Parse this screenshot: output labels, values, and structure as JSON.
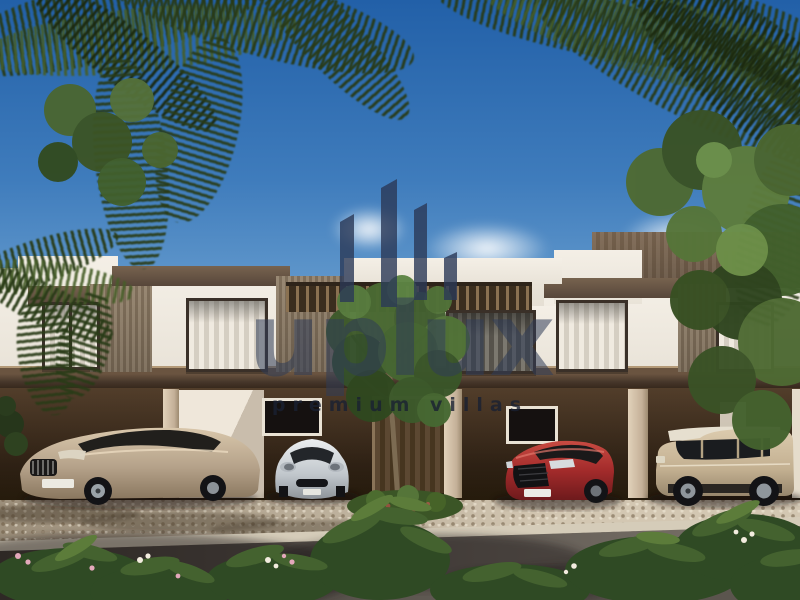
{
  "watermark": {
    "brand": "uplux",
    "tagline": "premium villas",
    "logo_icon": "skyline-bars-icon",
    "color": "#2f3c58"
  },
  "scene": {
    "type": "architectural-exterior-render",
    "title": "Modern two-storey townhouse row with carports",
    "time_of_day": "day",
    "sky": {
      "top_color": "#2260a8",
      "horizon_color": "#bdd6ea",
      "clouds": 3
    },
    "building": {
      "storeys": 2,
      "style": "contemporary flat-roof townhouses",
      "materials": [
        "white render",
        "timber slat panels",
        "dark bronze window frames"
      ],
      "features": [
        "rooftop parapets",
        "slatted pergola balcony",
        "shaded carports",
        "central entrance door",
        "curtained windows"
      ]
    },
    "vehicles": [
      {
        "name": "luxury sedan",
        "color_hex": "#b5a28a",
        "position": "left carport"
      },
      {
        "name": "sports car",
        "color_hex": "#c6cbd0",
        "position": "center-left carport"
      },
      {
        "name": "performance sedan",
        "color_hex": "#a32b2b",
        "position": "center-right carport"
      },
      {
        "name": "luxury suv",
        "color_hex": "#c3b091",
        "position": "right carport"
      }
    ],
    "vegetation": [
      "overhanging palm fronds",
      "palm tree",
      "entrance tree",
      "flowering shrubs",
      "street hedge"
    ],
    "ground": [
      "cobblestone driveway",
      "concrete curb",
      "asphalt road with palm shadows"
    ]
  }
}
